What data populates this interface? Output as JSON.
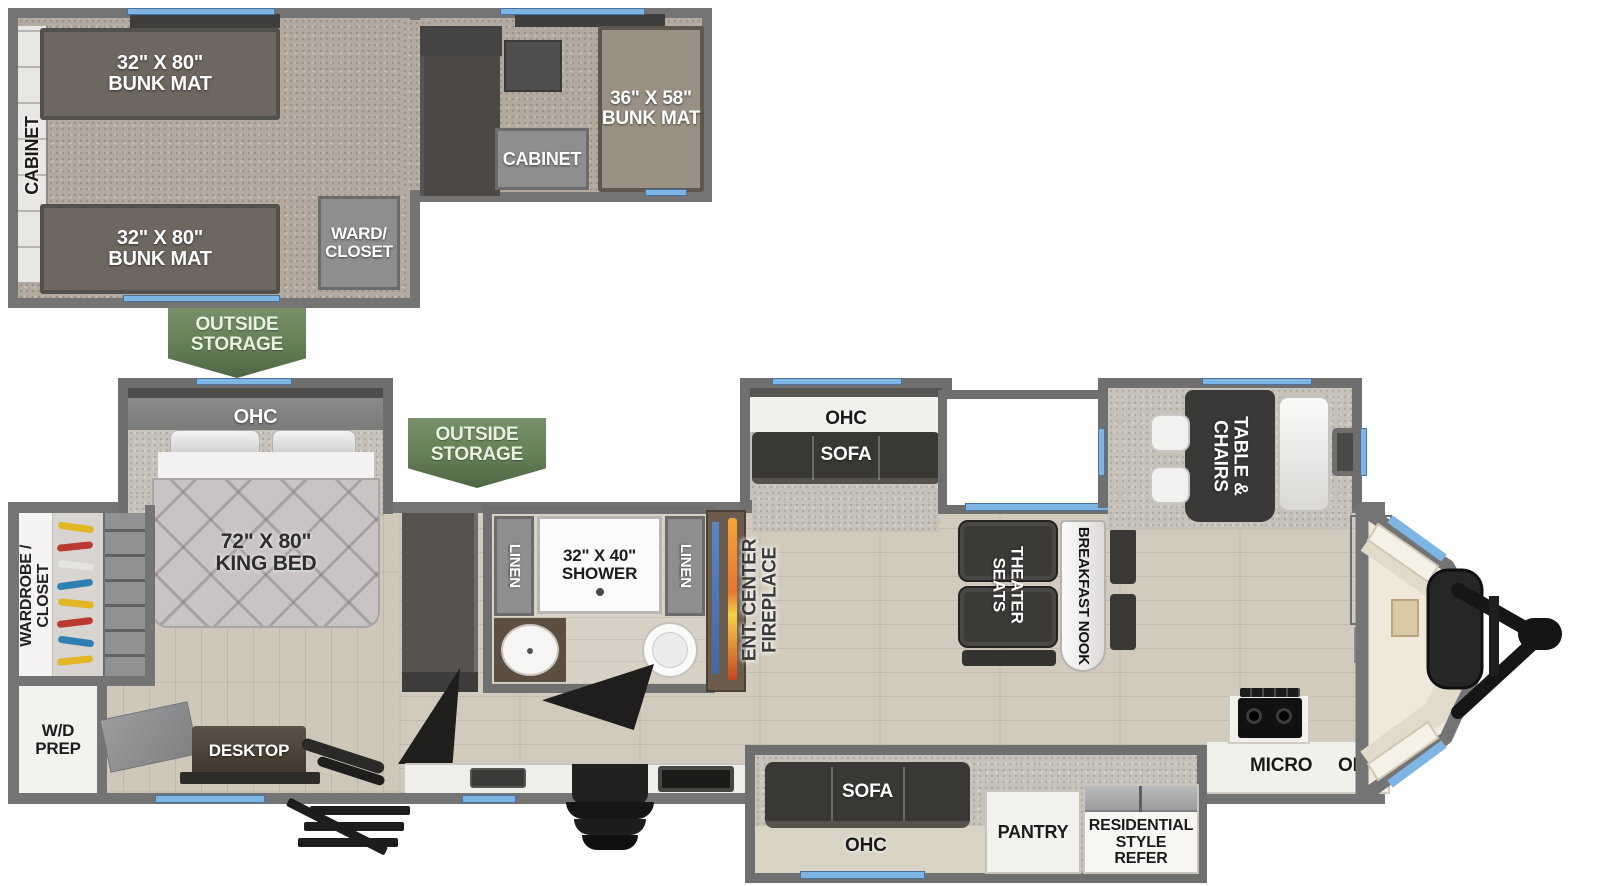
{
  "colors": {
    "wall_gray": "#747474",
    "window_blue": "#7db6e4",
    "banner_green": "#64805a",
    "carpet_tan": "#b3a99e",
    "wood_floor": "#d2cabd",
    "furniture_dark": "#3a3835",
    "fireplace_flame": "#e8762e",
    "tv_blue": "#4a77b5"
  },
  "loft": {
    "cabinet_left": "CABINET",
    "bunk_top": {
      "line1": "32\" X 80\"",
      "line2": "BUNK MAT"
    },
    "bunk_bottom": {
      "line1": "32\" X 80\"",
      "line2": "BUNK MAT"
    },
    "bunk_right": {
      "line1": "36\" X 58\"",
      "line2": "BUNK MAT"
    },
    "ward_closet": {
      "line1": "WARD/",
      "line2": "CLOSET"
    },
    "cabinet_mid": "CABINET"
  },
  "banners": {
    "outside_storage_1": {
      "line1": "OUTSIDE",
      "line2": "STORAGE"
    },
    "outside_storage_2": {
      "line1": "OUTSIDE",
      "line2": "STORAGE"
    }
  },
  "bedroom": {
    "ohc": "OHC",
    "king_bed": {
      "line1": "72\" X 80\"",
      "line2": "KING BED"
    },
    "wardrobe": {
      "line1": "WARDROBE /",
      "line2": "CLOSET"
    },
    "wd_prep": {
      "line1": "W/D",
      "line2": "PREP"
    },
    "desktop": "DESKTOP"
  },
  "bath": {
    "linen_left": "LINEN",
    "linen_right": "LINEN",
    "shower": {
      "line1": "32\" X 40\"",
      "line2": "SHOWER"
    }
  },
  "living": {
    "ent_center": {
      "line1": "ENT. CENTER",
      "line2": "FIREPLACE"
    },
    "sofa_slide": {
      "ohc": "OHC",
      "sofa": "SOFA"
    },
    "theater": {
      "line1": "THEATER",
      "line2": "SEATS"
    },
    "nook": "BREAKFAST NOOK",
    "table": {
      "line1": "TABLE &",
      "line2": "CHAIRS"
    }
  },
  "kitchen": {
    "micro": "MICRO",
    "ohc": "OHC"
  },
  "bottom_slide": {
    "sofa": "SOFA",
    "ohc": "OHC",
    "pantry": "PANTRY",
    "refer": {
      "line1": "RESIDENTIAL",
      "line2": "STYLE",
      "line3": "REFER"
    }
  }
}
